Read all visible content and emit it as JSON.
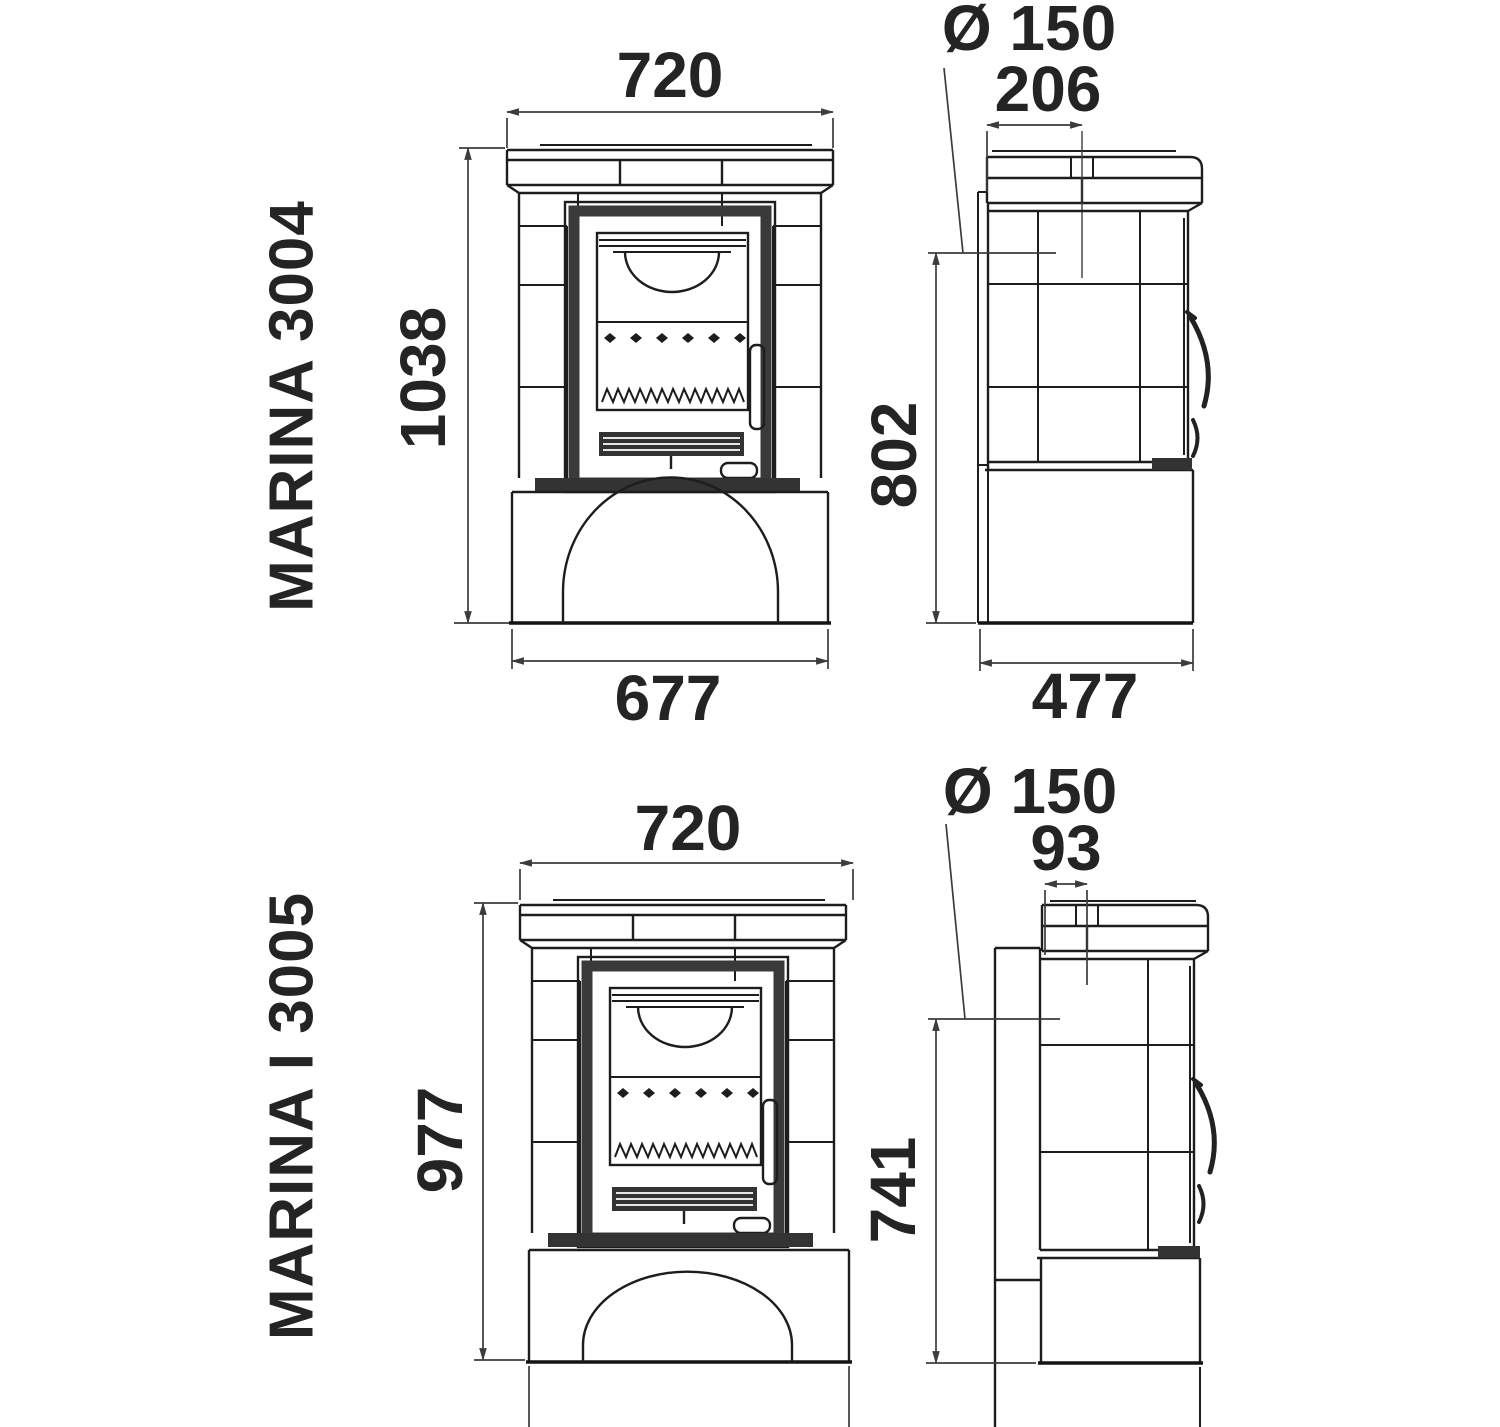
{
  "colors": {
    "line": "#1d1d1d",
    "dimension": "#3c3c3c",
    "text": "#242424",
    "dark_fill": "#333333",
    "background": "#ffffff"
  },
  "models": [
    {
      "name": "MARINA 3004",
      "front": {
        "width_top": "720",
        "height": "1038",
        "width_base": "677"
      },
      "side": {
        "flue_diameter": "Ø 150",
        "flue_offset_from_back": "206",
        "rear_flue_height": "802",
        "depth": "477"
      }
    },
    {
      "name": "MARINA I 3005",
      "front": {
        "width_top": "720",
        "height": "977"
      },
      "side": {
        "flue_diameter": "Ø 150",
        "flue_offset_from_back": "93",
        "rear_flue_height": "741"
      }
    }
  ]
}
